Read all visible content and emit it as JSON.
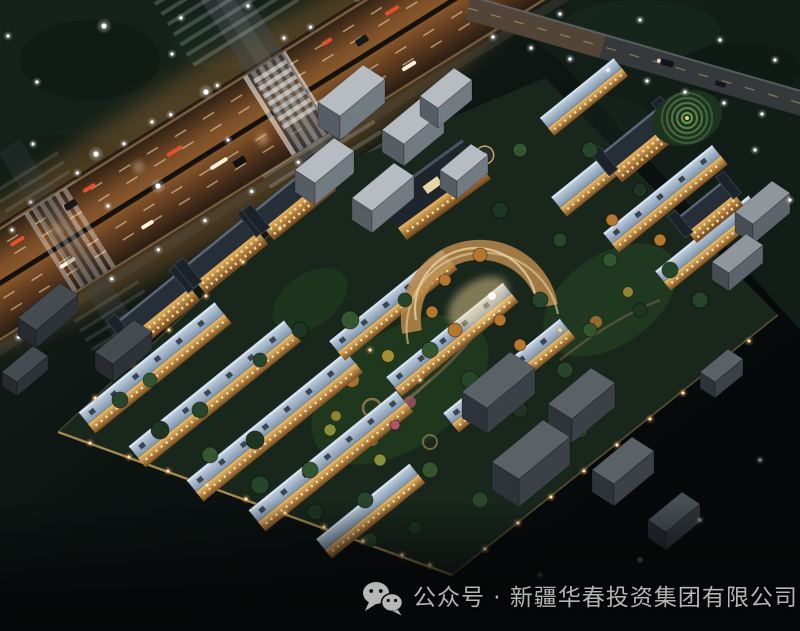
{
  "scene": {
    "subject": "aerial night-view rendering of a residential community beside an illuminated highway",
    "palette": {
      "night_trees": "#15221b",
      "background_dark": "#05070a",
      "highway_glow": "#c27a35",
      "lane_marking": "#f6dca8",
      "building_facade_light": "#e8b562",
      "townhouse_roof": "#a9bed2",
      "apartment_roof": "#262e38",
      "context_building_gray": "#b6bcc2",
      "lawn_green": "#223c1f",
      "autumn_tree_orange": "#b5772e",
      "street_lamp_white": "#ffffff",
      "street_lamp_warm": "#ffd9a2"
    }
  },
  "watermark": {
    "icon": "wechat-icon",
    "label": "公众号 · 新疆华春投资集团有限公司"
  }
}
